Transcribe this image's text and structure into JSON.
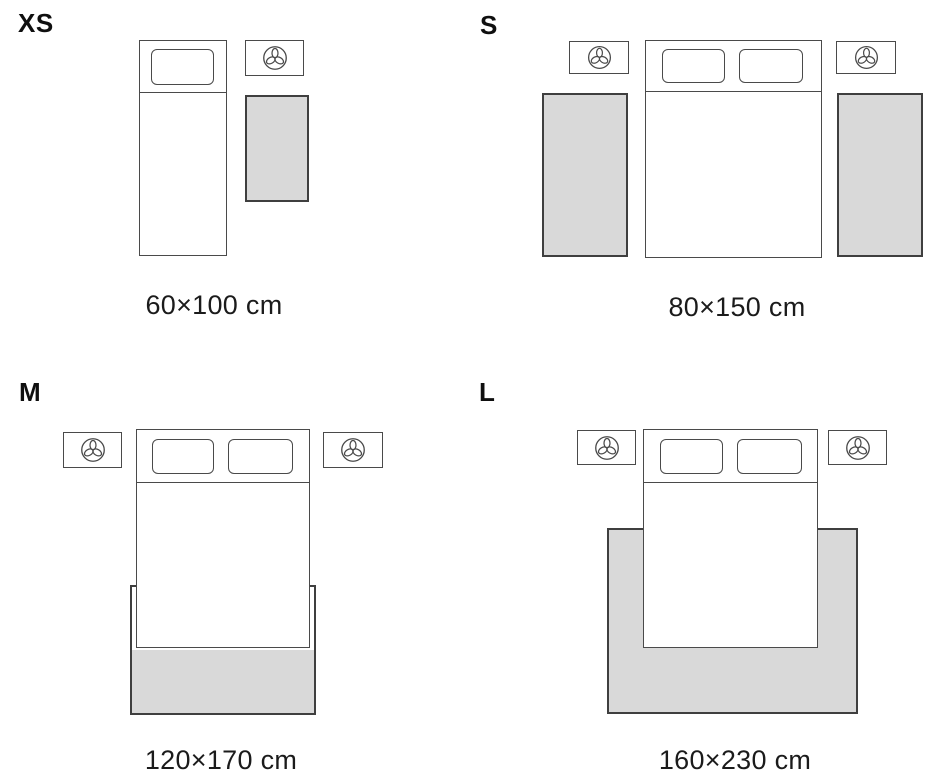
{
  "canvas": {
    "width": 940,
    "height": 780,
    "background": "#ffffff"
  },
  "colors": {
    "canvas_bg": "#ffffff",
    "furniture_line": "#4a4a4a",
    "rug_border": "#3f3f3f",
    "rug_fill": "#d9d9d9",
    "label_text": "#0f0f0f",
    "dimension_text": "#1b1b1b"
  },
  "icons": {
    "nightstand_icon": "plant-top-view-icon"
  },
  "sizes": [
    {
      "label": "XS",
      "dimension": "60×100 cm"
    },
    {
      "label": "S",
      "dimension": "80×150 cm"
    },
    {
      "label": "M",
      "dimension": "120×170 cm"
    },
    {
      "label": "L",
      "dimension": "160×230 cm"
    }
  ]
}
